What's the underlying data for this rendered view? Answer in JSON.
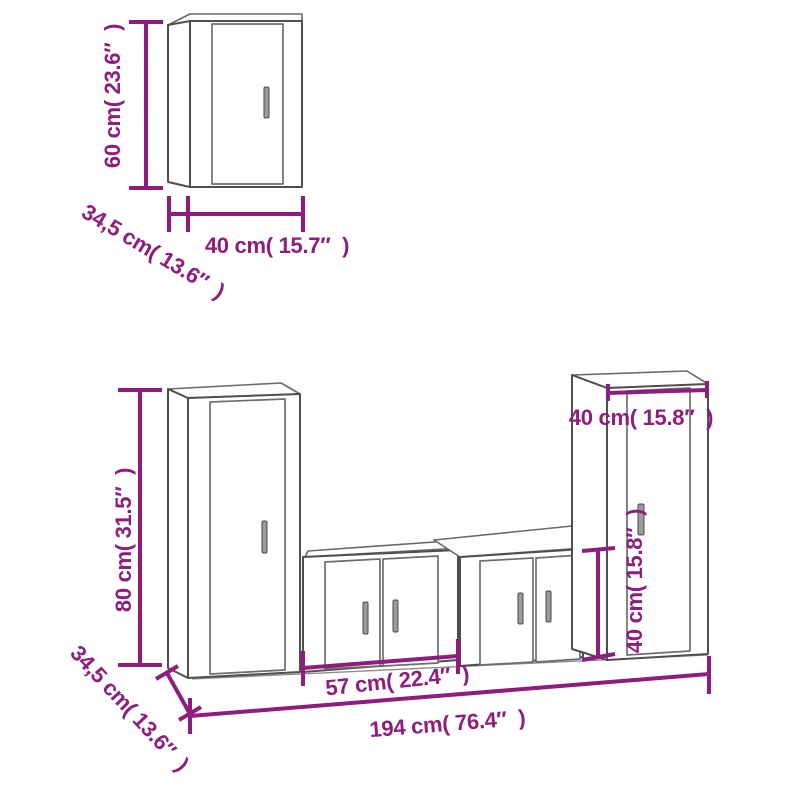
{
  "colors": {
    "dimension_accent": "#8e1d7e",
    "cabinet_outline": "#4f4f4f"
  },
  "labels": {
    "top_height": "60 cm( 23.6″  )",
    "top_width": "40 cm( 15.7″  )",
    "top_depth": "34,5 cm( 13.6″  )",
    "set_height": "80 cm( 31.5″  )",
    "set_depth": "34,5 cm( 13.6″  )",
    "set_center_width": "57 cm( 22.4″  )",
    "set_total_width": "194 cm( 76.4″  )",
    "set_right_width": "40 cm( 15.8″  )",
    "set_right_height": "40 cm( 15.8″  )"
  }
}
